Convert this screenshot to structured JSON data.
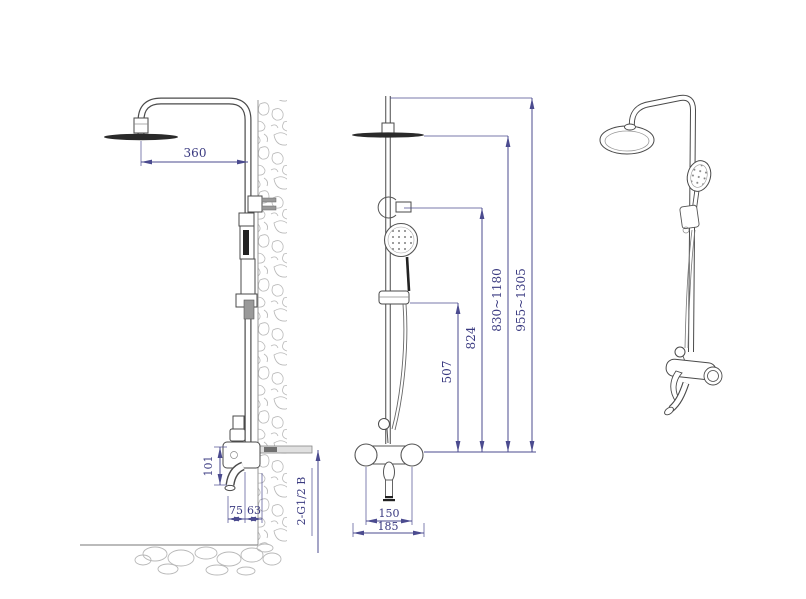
{
  "colors": {
    "background": "#ffffff",
    "dimension_line": "#4b4b8f",
    "dimension_text": "#3a3a80",
    "object_line": "#4a4a4a",
    "dark_fill": "#2a2a2a",
    "hatch": "#b8b8b8"
  },
  "dimensions": {
    "side_view": {
      "arm_reach": "360",
      "mixer_height": "101",
      "spout_projection": "75",
      "pipe_to_wall": "63",
      "inlet_spec": "2-G1/2 B"
    },
    "front_view": {
      "holder_height": "507",
      "bracket_height": "824",
      "rain_head_height_range": "830~1180",
      "overall_height_range": "955~1305",
      "union_spacing": "150",
      "body_width": "185"
    }
  }
}
